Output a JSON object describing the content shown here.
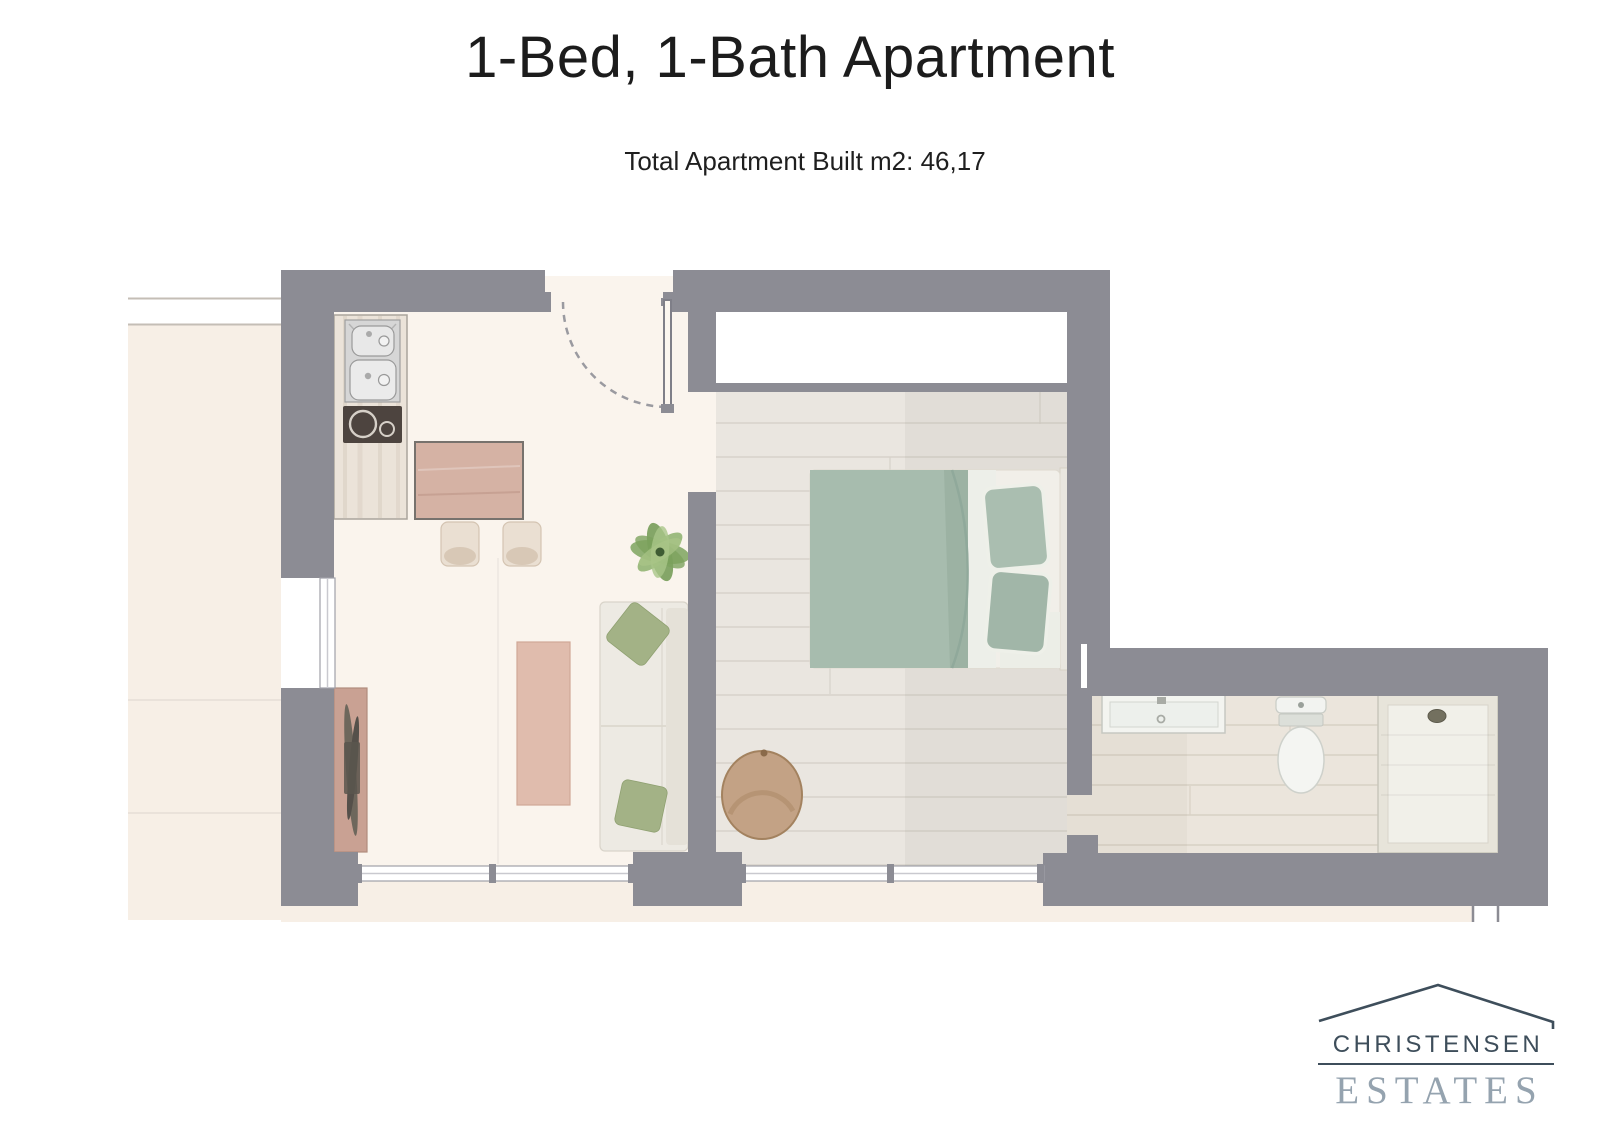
{
  "header": {
    "title": "1-Bed, 1-Bath Apartment",
    "subtitle": "Total Apartment Built m2: 46,17"
  },
  "logo": {
    "brand": "CHRISTENSEN",
    "division": "ESTATES"
  },
  "colors": {
    "wall": "#8c8c94",
    "terrace": "#f7efe6",
    "interior_floor": "#faf4ed",
    "wood_floor": "#eae6e0",
    "plank_line": "#d7d2ca",
    "bed_green": "#a7bcae",
    "pillow_green": "#a3b286",
    "furniture_wood": "#d5b2a4",
    "cooktop_dark": "#4d443f",
    "armchair_tan": "#c3a285",
    "logo_dark": "#3e4e5b",
    "logo_light": "#95a3af"
  }
}
